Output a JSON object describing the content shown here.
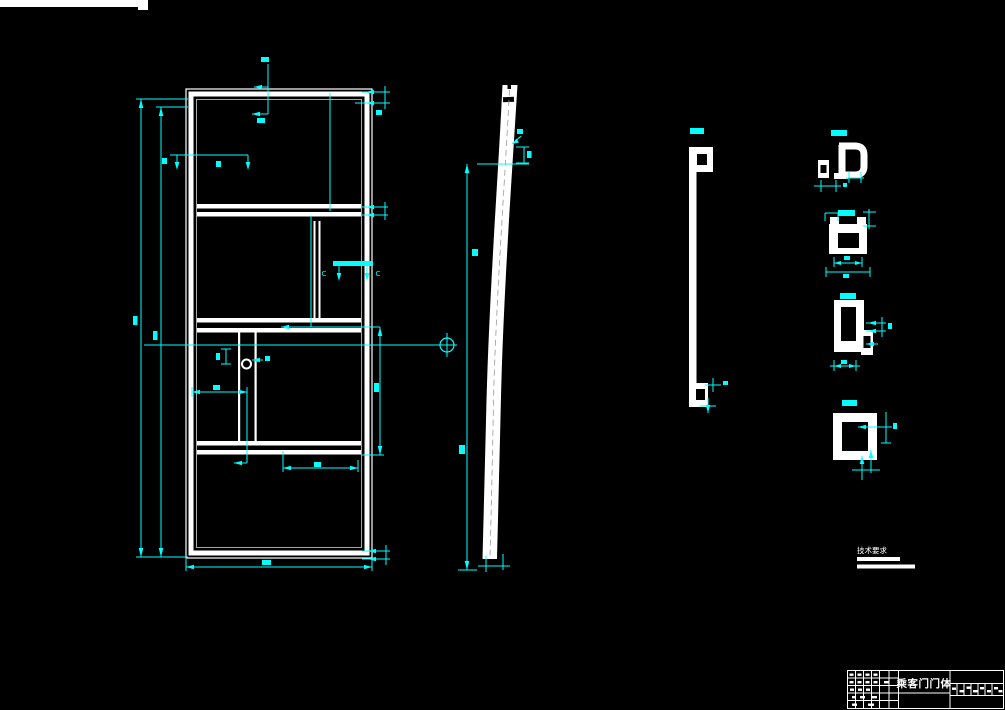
{
  "colors": {
    "background": "#000000",
    "geometry_lines": "#ffffff",
    "dimension_lines": "#00ffff"
  },
  "drawing": {
    "title_block": {
      "drawing_title": "乘客门门体"
    },
    "notes": {
      "heading": "技术要求"
    },
    "section_labels": {
      "c_left": "C",
      "c_right": "C"
    }
  }
}
